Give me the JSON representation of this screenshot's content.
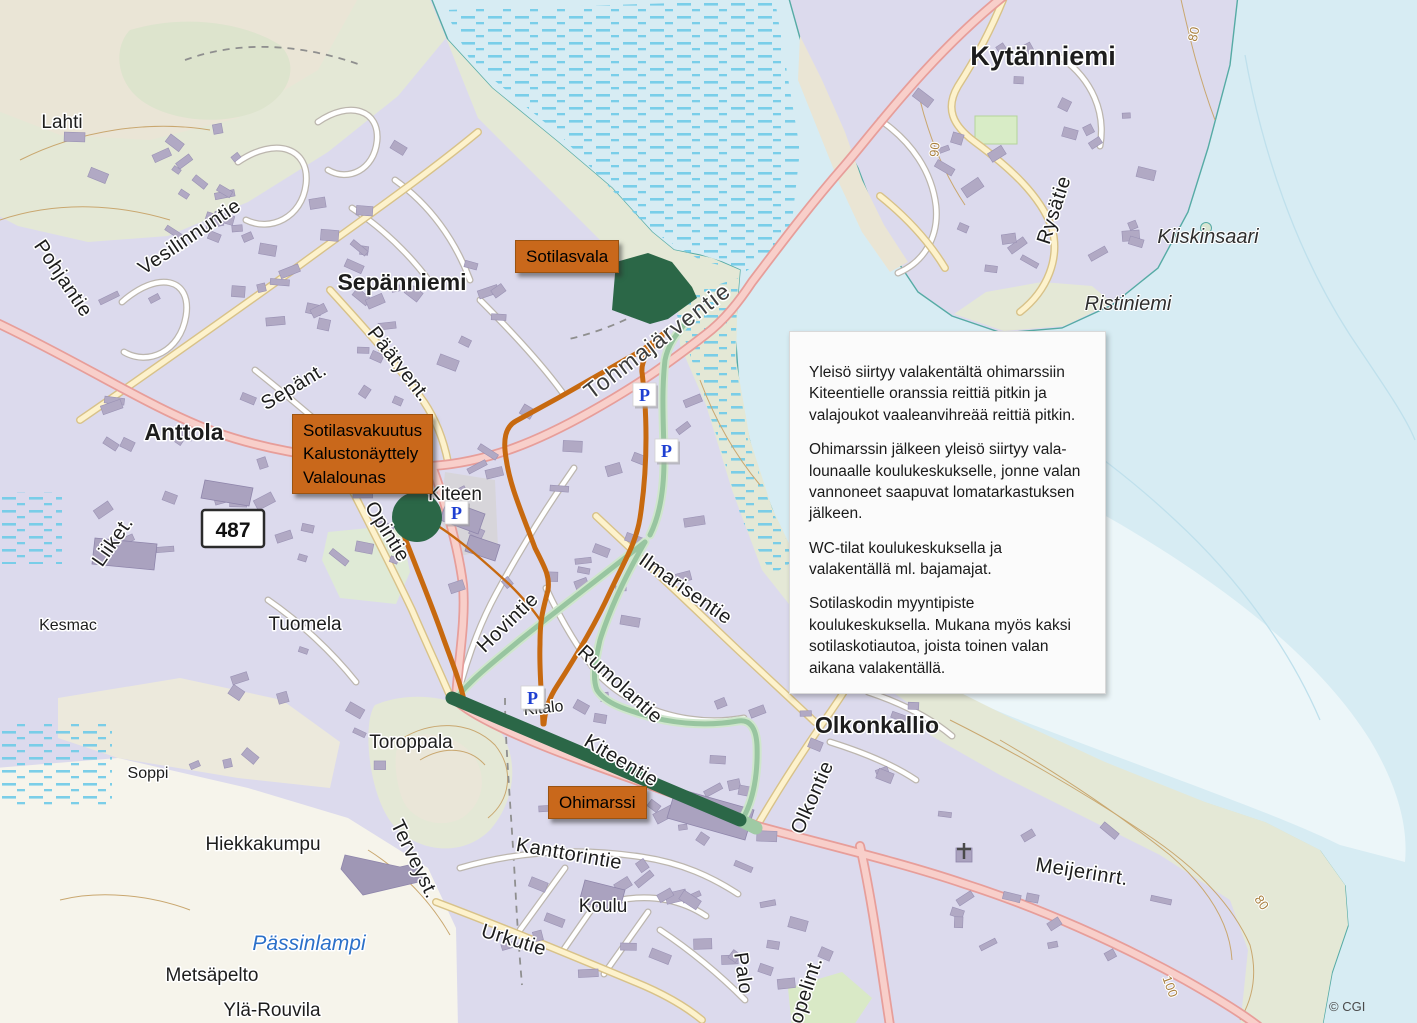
{
  "map": {
    "attribution": "© CGI",
    "road_shield": {
      "text": "487",
      "x": 233,
      "y": 529
    },
    "parking": {
      "letter": "P",
      "positions": [
        {
          "x": 633,
          "y": 383
        },
        {
          "x": 655,
          "y": 439
        },
        {
          "x": 521,
          "y": 686
        },
        {
          "x": 445,
          "y": 501
        }
      ]
    },
    "overlay_boxes": [
      {
        "name": "sotilasvala-label",
        "x": 515,
        "y": 240,
        "lines": [
          "Sotilasvala"
        ]
      },
      {
        "name": "sotilasvakuutus-label",
        "x": 292,
        "y": 414,
        "lines": [
          "Sotilasvakuutus",
          "Kalustonäyttely",
          "Valalounas"
        ]
      },
      {
        "name": "ohimarssi-label",
        "x": 548,
        "y": 786,
        "lines": [
          "Ohimarssi"
        ]
      }
    ],
    "info_box": {
      "paragraphs": [
        "Yleisö siirtyy valakentältä ohimarssiin Kiteentielle oranssia reittiä pitkin ja valajoukot vaaleanvihreää reittiä pitkin.",
        "Ohimarssin jälkeen yleisö siirtyy vala­lounaalle koulukeskukselle, jonne valan vannoneet saapuvat lomatarkastuksen jälkeen.",
        "WC-tilat koulukeskuksella ja valakentällä ml. bajamajat.",
        "Sotilaskodin myyntipiste koulukeskuksella. Mukana myös kaksi sotilaskotiautoa, joista toinen valan aikana valakentällä."
      ]
    },
    "legend_colors": {
      "orange_route": "#c7690f",
      "light_green_route": "#98c5a0",
      "dark_green_march": "#2b6747",
      "annotation_box": "#c9681b",
      "water": "#d7ecf3",
      "residential": "#dcdaed"
    },
    "place_labels": [
      {
        "t": "Lahti",
        "x": 62,
        "y": 128,
        "r": 0,
        "c": "name-lg"
      },
      {
        "t": "Pohjantie",
        "x": 58,
        "y": 282,
        "r": 56,
        "c": "street-lg"
      },
      {
        "t": "Vesilinnuntie",
        "x": 193,
        "y": 242,
        "r": -34,
        "c": "street-lg"
      },
      {
        "t": "Sepänniemi",
        "x": 402,
        "y": 290,
        "r": 0,
        "c": "town"
      },
      {
        "t": "Päätyent.",
        "x": 394,
        "y": 368,
        "r": 52,
        "c": "street-lg"
      },
      {
        "t": "Sepänt.",
        "x": 297,
        "y": 392,
        "r": -31,
        "c": "street-lg"
      },
      {
        "t": "Anttola",
        "x": 184,
        "y": 440,
        "r": 0,
        "c": "town"
      },
      {
        "t": "Kytänniemi",
        "x": 1043,
        "y": 65,
        "r": 0,
        "c": "town-lg"
      },
      {
        "t": "Rysätie",
        "x": 1060,
        "y": 212,
        "r": -72,
        "c": "street-lg"
      },
      {
        "t": "Kiiskinsaari",
        "x": 1208,
        "y": 243,
        "r": 0,
        "c": "water-name"
      },
      {
        "t": "Ristiniemi",
        "x": 1128,
        "y": 310,
        "r": 0,
        "c": "water-name"
      },
      {
        "t": "Tohmajärventie",
        "x": 662,
        "y": 347,
        "r": -37,
        "c": "street-xl"
      },
      {
        "t": "Liiket.",
        "x": 118,
        "y": 545,
        "r": -55,
        "c": "street-lg"
      },
      {
        "t": "Opintie",
        "x": 382,
        "y": 535,
        "r": 58,
        "c": "street-lg"
      },
      {
        "t": "Kesmac",
        "x": 68,
        "y": 630,
        "r": 0,
        "c": "name"
      },
      {
        "t": "Tuomela",
        "x": 305,
        "y": 630,
        "r": 0,
        "c": "name-lg"
      },
      {
        "t": "Hovintie",
        "x": 512,
        "y": 627,
        "r": -44,
        "c": "street-lg"
      },
      {
        "t": "Rumolantie",
        "x": 616,
        "y": 689,
        "r": 42,
        "c": "street-lg"
      },
      {
        "t": "Ilmarisentie",
        "x": 682,
        "y": 594,
        "r": 35,
        "c": "street-lg"
      },
      {
        "t": "Olkonkallio",
        "x": 877,
        "y": 733,
        "r": 0,
        "c": "town"
      },
      {
        "t": "Toroppala",
        "x": 411,
        "y": 748,
        "r": 0,
        "c": "name-lg"
      },
      {
        "t": "Soppi",
        "x": 148,
        "y": 778,
        "r": 0,
        "c": "name"
      },
      {
        "t": "Hiekkakumpu",
        "x": 263,
        "y": 850,
        "r": 0,
        "c": "name-lg"
      },
      {
        "t": "Terveyst.",
        "x": 409,
        "y": 862,
        "r": 64,
        "c": "street-lg"
      },
      {
        "t": "Kanttorintie",
        "x": 568,
        "y": 860,
        "r": 10,
        "c": "street-lg"
      },
      {
        "t": "Koulu",
        "x": 603,
        "y": 912,
        "r": 0,
        "c": "name-lg"
      },
      {
        "t": "Urkutie",
        "x": 512,
        "y": 946,
        "r": 17,
        "c": "street-lg"
      },
      {
        "t": "Pässinlampi",
        "x": 309,
        "y": 950,
        "r": 0,
        "c": "lake-name"
      },
      {
        "t": "Metsäpelto",
        "x": 212,
        "y": 981,
        "r": 0,
        "c": "name-lg"
      },
      {
        "t": "Ylä-Rouvila",
        "x": 272,
        "y": 1016,
        "r": 0,
        "c": "name-lg"
      },
      {
        "t": "Olkontie",
        "x": 818,
        "y": 800,
        "r": -66,
        "c": "street-lg"
      },
      {
        "t": "Meijerinrt.",
        "x": 1081,
        "y": 878,
        "r": 9,
        "c": "street-lg"
      },
      {
        "t": "Palo",
        "x": 737,
        "y": 974,
        "r": 82,
        "c": "street-lg"
      },
      {
        "t": "opelint.",
        "x": 812,
        "y": 992,
        "r": -72,
        "c": "street-lg"
      },
      {
        "t": "Kitalo",
        "x": 544,
        "y": 713,
        "r": -6,
        "c": "name"
      },
      {
        "t": "Kiteentie",
        "x": 618,
        "y": 766,
        "r": 31,
        "c": "street-lg"
      },
      {
        "t": "Kiteen",
        "x": 455,
        "y": 500,
        "r": 0,
        "c": "name-lg"
      },
      {
        "t": "80",
        "x": 1198,
        "y": 35,
        "r": -78,
        "c": "contour"
      },
      {
        "t": "90",
        "x": 939,
        "y": 150,
        "r": -85,
        "c": "contour"
      },
      {
        "t": "80",
        "x": 1258,
        "y": 905,
        "r": 55,
        "c": "contour"
      },
      {
        "t": "100",
        "x": 1166,
        "y": 988,
        "r": 70,
        "c": "contour"
      }
    ]
  }
}
